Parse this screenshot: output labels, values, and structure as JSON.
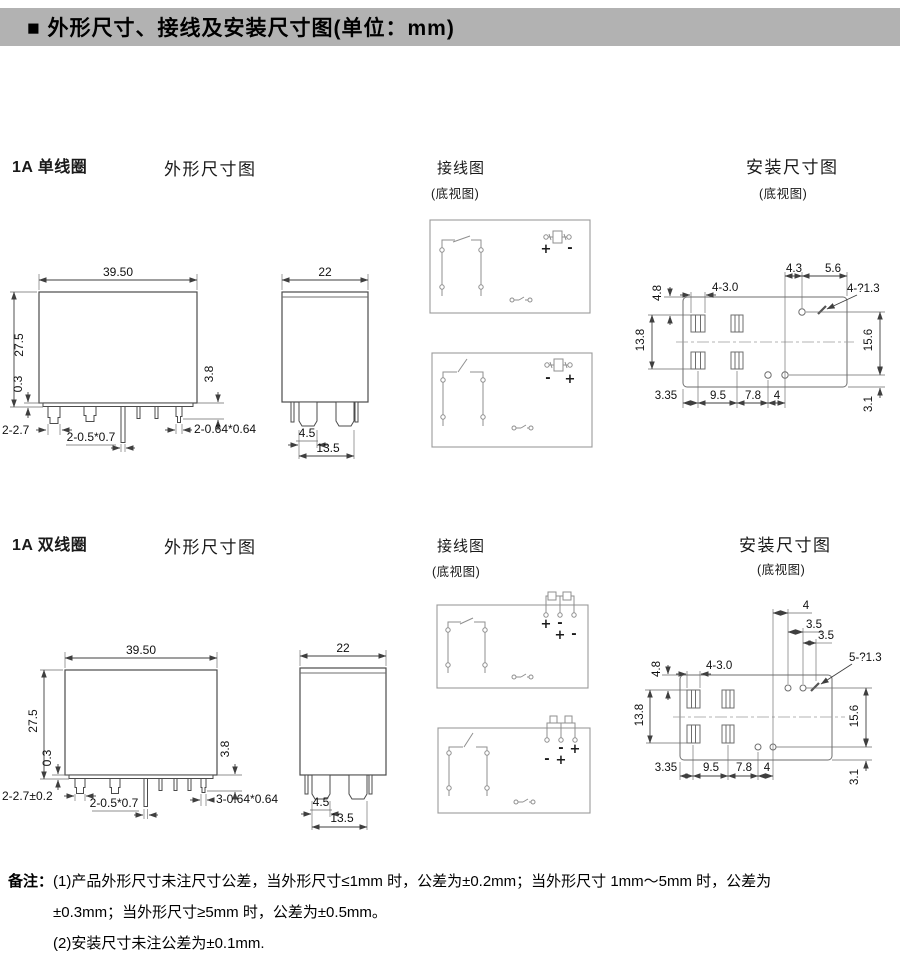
{
  "header": {
    "title": "■ 外形尺寸、接线及安装尺寸图(单位：mm)"
  },
  "row1": {
    "title": "1A 单线圈",
    "outline_label": "外形尺寸图",
    "wiring_label": "接线图",
    "wiring_note": "(底视图)",
    "mounting_label": "安装尺寸图",
    "mounting_note": "(底视图)",
    "front": {
      "width": "39.50",
      "height": "27.5",
      "standoff": "0.3",
      "pin_length": "3.8",
      "pin_dim_left": "2-2.7",
      "pin_dim_mid": "2-0.5*0.7",
      "pin_dim_right": "2-0.64*0.64"
    },
    "side": {
      "width": "22",
      "pin_width": "4.5",
      "pin_span": "13.5"
    },
    "wiring_top": {
      "signs": [
        "+",
        "-"
      ]
    },
    "wiring_bottom": {
      "signs": [
        "-",
        "+"
      ]
    },
    "mounting": {
      "top1": "4.3",
      "top2": "5.6",
      "holes": "4-?1.3",
      "slots": "4-3.0",
      "left_top": "4.8",
      "left_side": "13.8",
      "right_side": "15.6",
      "right_bottom": "3.1",
      "bottom1": "3.35",
      "bottom2": "9.5",
      "bottom3": "7.8",
      "bottom4": "4"
    }
  },
  "row2": {
    "title": "1A 双线圈",
    "outline_label": "外形尺寸图",
    "wiring_label": "接线图",
    "wiring_note": "(底视图)",
    "mounting_label": "安装尺寸图",
    "mounting_note": "(底视图)",
    "front": {
      "width": "39.50",
      "height": "27.5",
      "standoff": "0.3",
      "pin_length": "3.8",
      "pin_dim_left": "2-2.7±0.2",
      "pin_dim_mid": "2-0.5*0.7",
      "pin_dim_right": "3-0.64*0.64"
    },
    "side": {
      "width": "22",
      "pin_width": "4.5",
      "pin_span": "13.5"
    },
    "wiring_top": {
      "signs": [
        "+",
        "-",
        "+",
        "-"
      ]
    },
    "wiring_bottom": {
      "signs": [
        "-",
        "+",
        "-",
        "+"
      ]
    },
    "mounting": {
      "top1": "4",
      "top2": "3.5",
      "top3": "3.5",
      "holes": "5-?1.3",
      "slots": "4-3.0",
      "left_top": "4.8",
      "left_side": "13.8",
      "right_side": "15.6",
      "right_bottom": "3.1",
      "bottom1": "3.35",
      "bottom2": "9.5",
      "bottom3": "7.8",
      "bottom4": "4"
    }
  },
  "notes": {
    "label": "备注：",
    "line1": "(1)产品外形尺寸未注尺寸公差，当外形尺寸≤1mm 时，公差为±0.2mm；当外形尺寸 1mm～5mm 时，公差为",
    "line2": "±0.3mm；当外形尺寸≥5mm 时，公差为±0.5mm。",
    "line3": "(2)安装尺寸未注公差为±0.1mm."
  }
}
